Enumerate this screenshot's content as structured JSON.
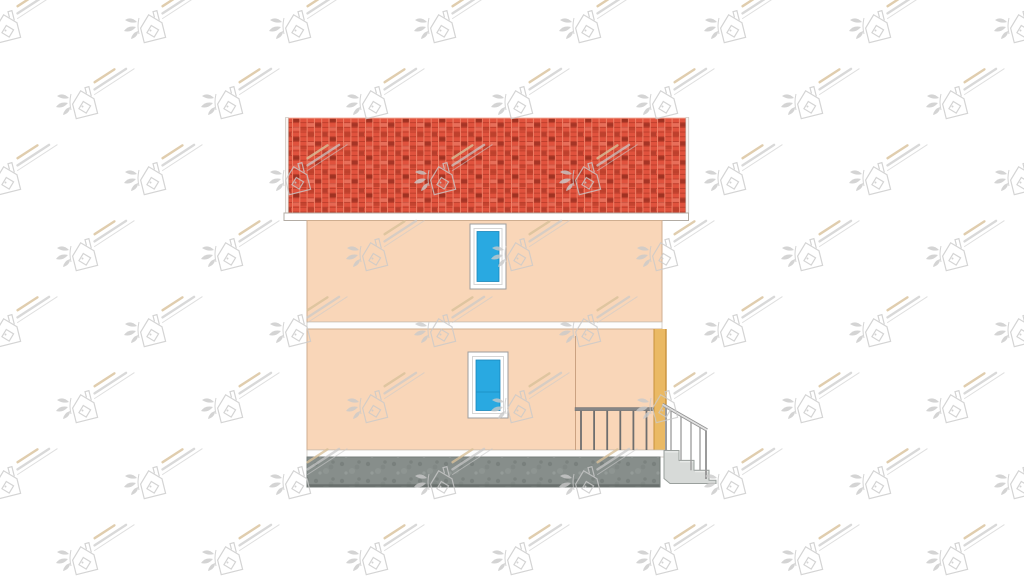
{
  "drawing": {
    "description": "Architectural side-elevation rendering of a two-storey house with red tiled roof, two blue windows, porch railing and entrance stairs on the right",
    "storeys": 2,
    "window_count": 2,
    "background": "#ffffff"
  },
  "palette": {
    "wall": "#f9d6b8",
    "wall_stroke": "#cfae90",
    "roof_base": "#e0523d",
    "roof_mortar": "#f08168",
    "roof_row_line": "#bb3d2b",
    "roof_dark": "#8e2a1c",
    "roof_mid": "#b23a28",
    "roof_light": "#f0907c",
    "fascia": "#ffffff",
    "fascia_stroke": "#b3aca4",
    "band": "#fdfdfd",
    "band_stroke": "#c6bfb7",
    "foundation": "#878e8b",
    "foundation_dark": "#5f6663",
    "foundation_stroke": "#767d7a",
    "frame_white": "#ffffff",
    "frame_stroke": "#9e9e9e",
    "frame_inner": "#d6d6d6",
    "glass": "#29a9e1",
    "glass_stroke": "#1886bb",
    "glass_line": "#1d92c6",
    "corner_strip": "#eab964",
    "corner_strip_edge": "#c8913c",
    "rail_dark": "#6e6e6e",
    "rail_mid": "#9b9b9b",
    "rail_hi": "#e2e2e2",
    "step_fill": "#d7dad8",
    "step_stroke": "#9aa09d",
    "step_hi": "#eef0ef",
    "divider": "#c49a78",
    "watermark_gray": "#c9c9c9",
    "watermark_tan": "#d8c09a"
  },
  "watermark": {
    "description": "faint repeated builder logo: small house with diamond window, leaf sprig and diagonal text lines",
    "tile_w": 145,
    "tile_h": 152
  },
  "porch_railing": {
    "count": 6,
    "x_start": 581,
    "spacing": 13.1,
    "baluster_top": 410.5,
    "baluster_bottom": 450,
    "rail_x": 575,
    "rail_y": 407.5,
    "rail_w": 78.5,
    "rail_h": 3.2
  },
  "stairs": {
    "count": 3,
    "top_x": 664,
    "top_y": 450.5,
    "tread": 15,
    "riser": 9.9,
    "end_x": 716,
    "base_y": 483.5
  },
  "stair_railing": {
    "rail": [
      662.5,
      404.5,
      707,
      430
    ],
    "post_left": [
      666,
      406.5,
      666,
      450.5
    ],
    "post_right": [
      706,
      429.5,
      706,
      479
    ],
    "balusters": [
      [
        671,
        410,
        671,
        450.5
      ],
      [
        681,
        415.5,
        681,
        460.4
      ],
      [
        691,
        421,
        691,
        470.3
      ],
      [
        700,
        426,
        700,
        470.3
      ]
    ]
  }
}
